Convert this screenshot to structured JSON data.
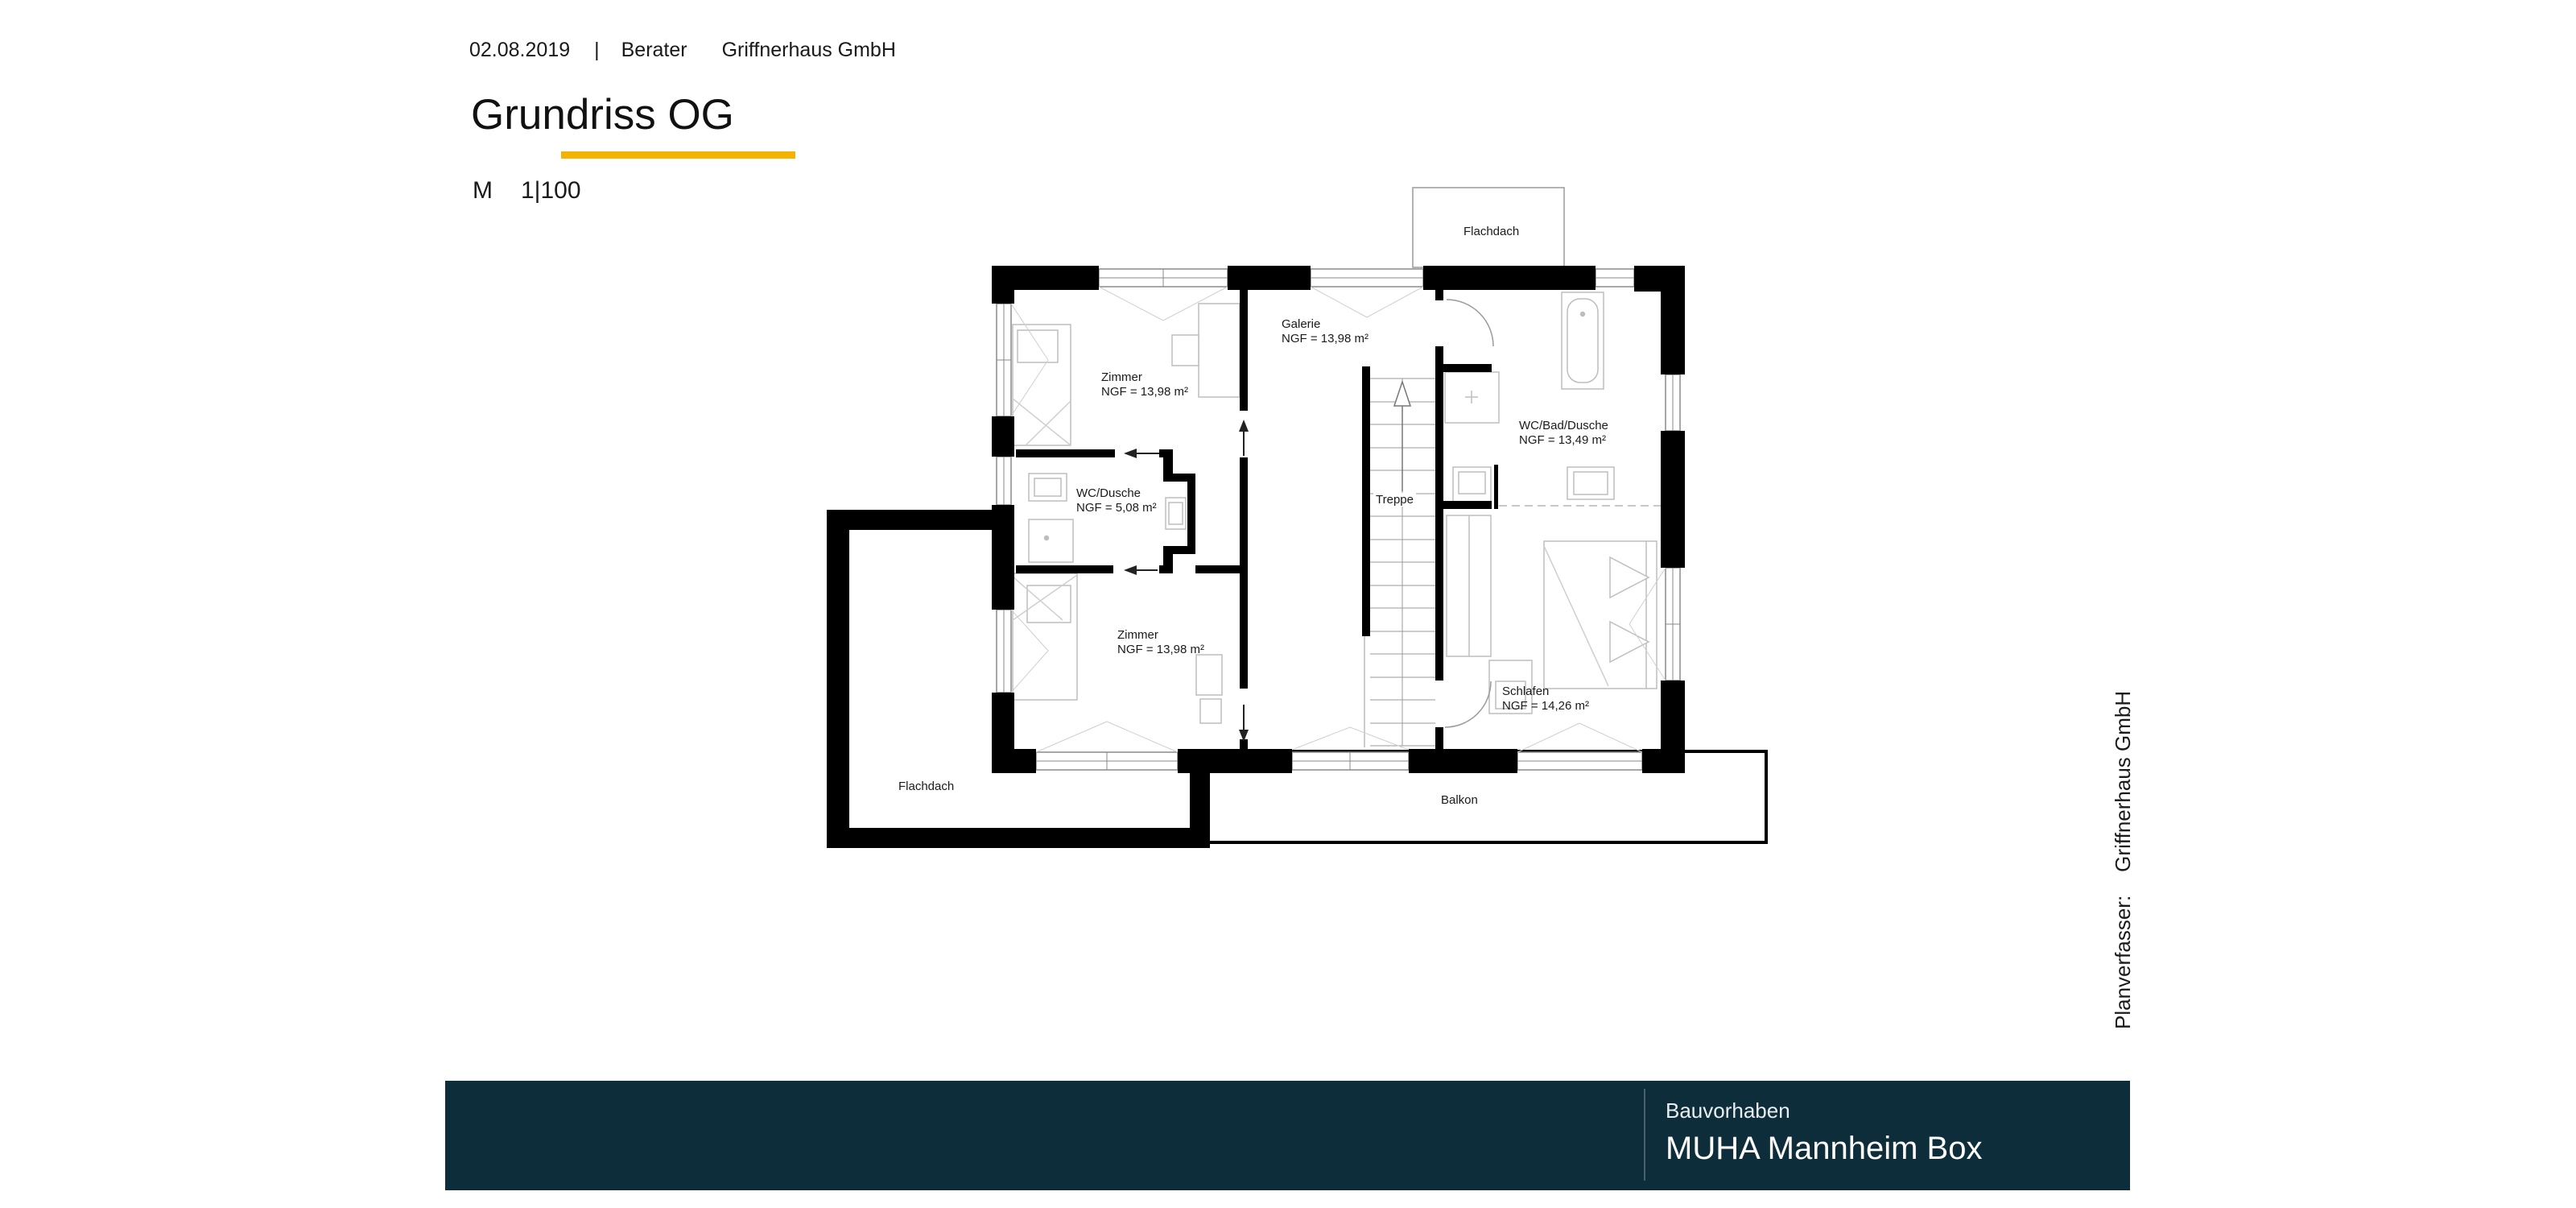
{
  "header": {
    "date": "02.08.2019",
    "divider": "|",
    "advisor_label": "Berater",
    "advisor_name": "Griffnerhaus GmbH"
  },
  "title": {
    "heading": "Grundriss OG",
    "scale_label": "M",
    "scale_value": "1|100"
  },
  "plan": {
    "rooms": {
      "zimmer_top": {
        "name": "Zimmer",
        "area": "NGF = 13,98 m²"
      },
      "galerie": {
        "name": "Galerie",
        "area": "NGF = 13,98 m²"
      },
      "wc_bad_dusche": {
        "name": "WC/Bad/Dusche",
        "area": "NGF = 13,49 m²"
      },
      "wc_dusche": {
        "name": "WC/Dusche",
        "area": "NGF = 5,08 m²"
      },
      "zimmer_bottom": {
        "name": "Zimmer",
        "area": "NGF = 13,98 m²"
      },
      "schlafen": {
        "name": "Schlafen",
        "area": "NGF = 14,26 m²"
      },
      "treppe": {
        "name": "Treppe"
      }
    },
    "outdoor": {
      "flachdach_top": {
        "name": "Flachdach"
      },
      "flachdach_left": {
        "name": "Flachdach"
      },
      "balkon": {
        "name": "Balkon"
      }
    }
  },
  "sidebar": {
    "author_label": "Planverfasser:",
    "author_name": "Griffnerhaus GmbH"
  },
  "footer": {
    "project_label": "Bauvorhaben",
    "project_name": "MUHA Mannheim Box"
  },
  "colors": {
    "accent": "#F5B301",
    "footer_bg": "#0E2D3A",
    "text": "#1A1A1A"
  }
}
